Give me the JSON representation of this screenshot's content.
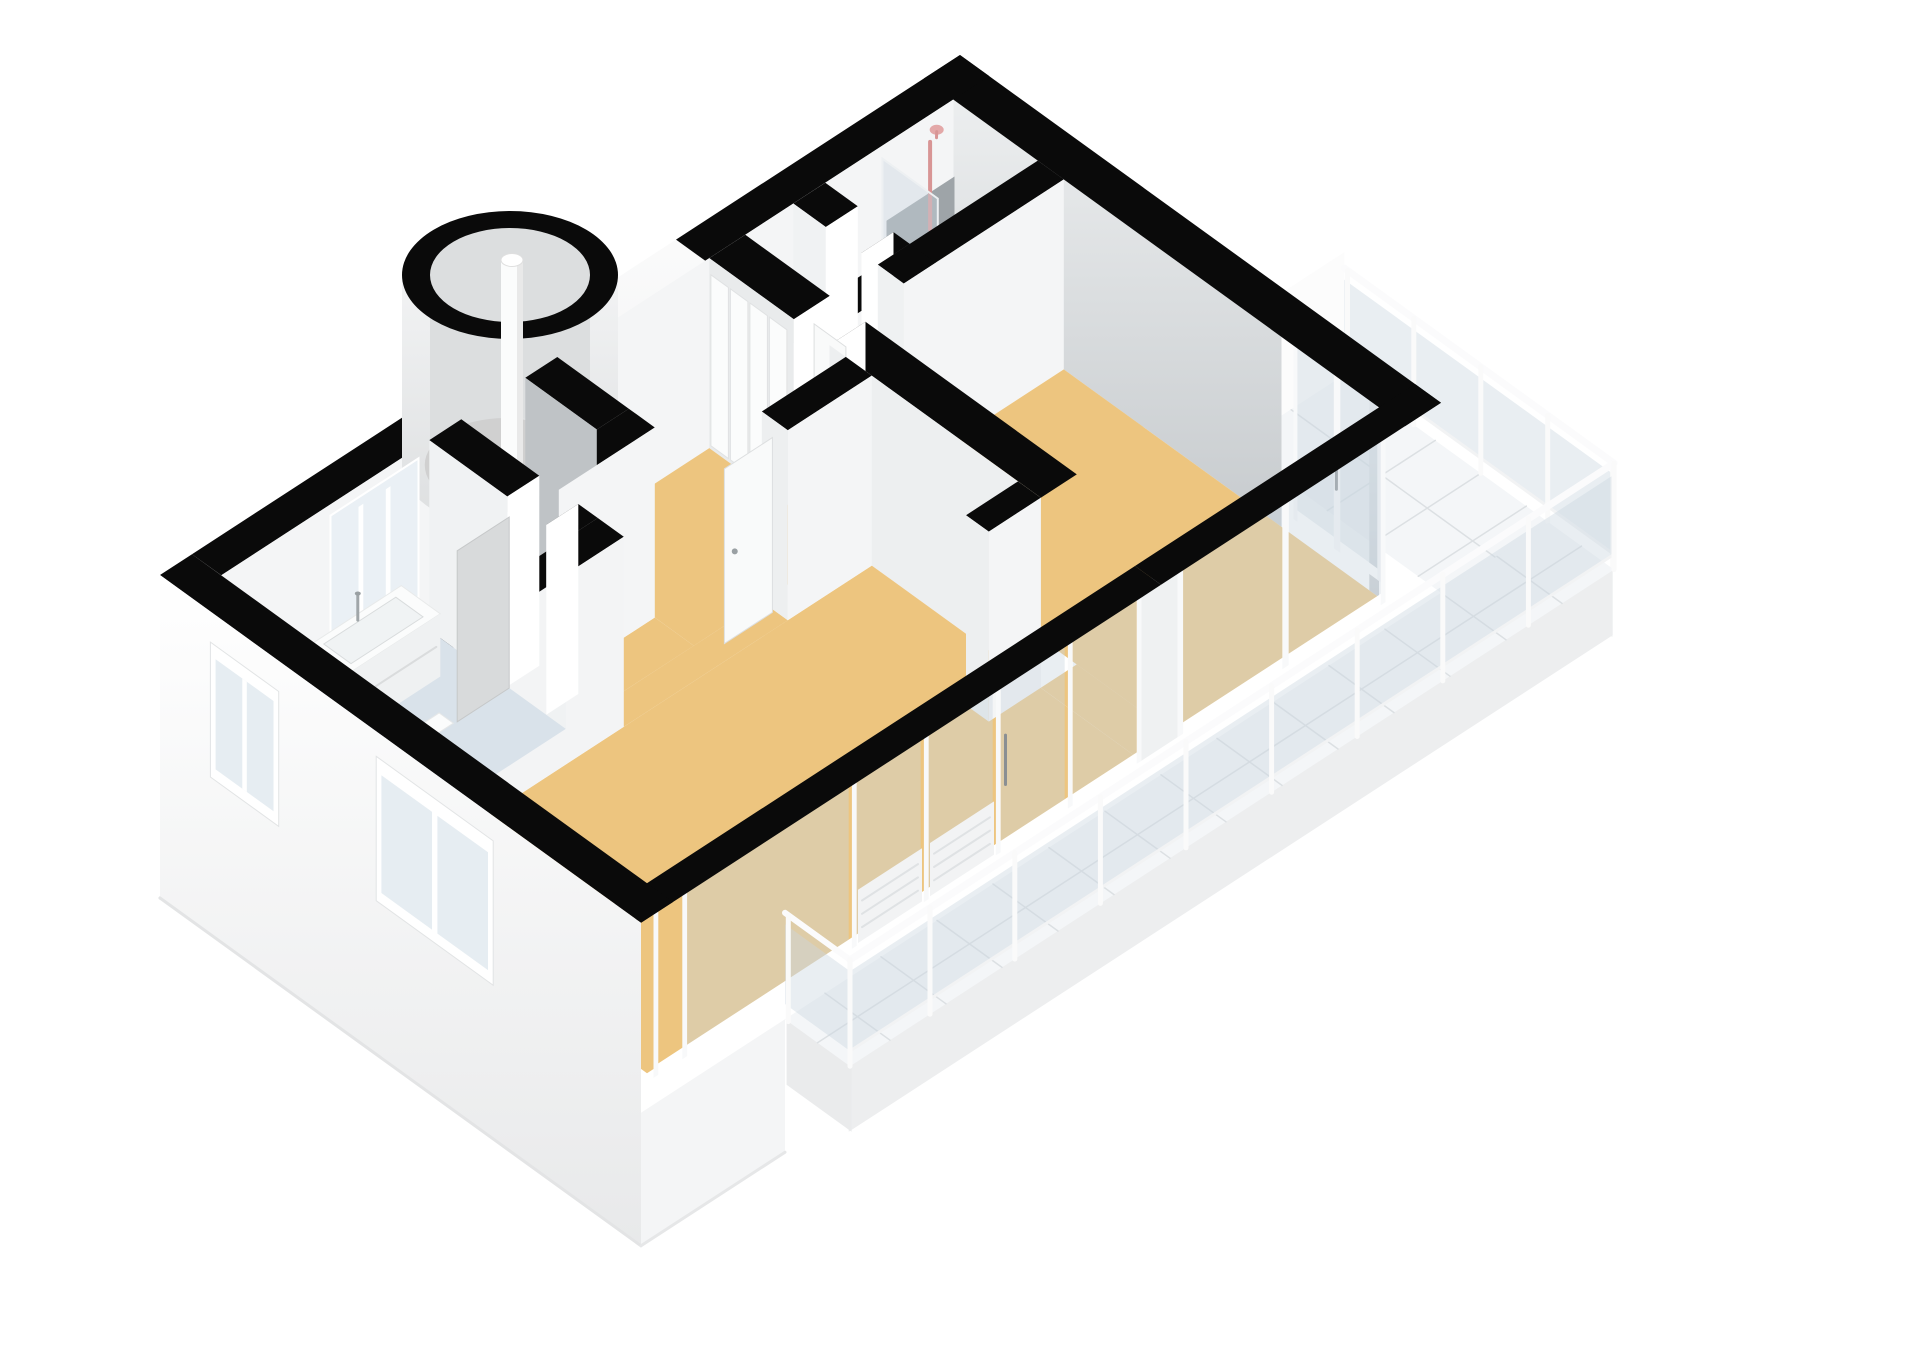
{
  "scene": {
    "label": "3D isometric floor plan of an apartment",
    "background": "#FFFFFF",
    "style": "isometric-3d-floorplan"
  },
  "palette": {
    "wall_top": "#0A0A0A",
    "wall_face_bright": "#F4F5F6",
    "wall_face_medium": "#EDEFF0",
    "wall_face_shaded": "#C7CBCE",
    "wall_face_dark": "#9EA4A8",
    "exterior_white": "#FFFFFF",
    "exterior_shade": "#E8E9EA",
    "floor_wood": "#EDC57F",
    "floor_bath": "#D9E2EA",
    "floor_tile": "#F4F6F8",
    "tile_line": "#DCE0E3",
    "floor_dark": "#3B3C3E",
    "floor_turret": "#D0D0D0",
    "glass": "rgba(203,214,224,0.42)",
    "glass_pane": "#E8EEF3",
    "frame_white": "#FFFFFF",
    "fixture_white": "#FBFCFC",
    "fixture_accent": "#D89595",
    "shadow": "#CBD0D4"
  },
  "rooms": [
    {
      "id": "living-room",
      "floor": "floor_wood"
    },
    {
      "id": "bedroom",
      "floor": "floor_wood"
    },
    {
      "id": "hallway",
      "floor": "floor_wood"
    },
    {
      "id": "corridor",
      "floor": "floor_wood"
    },
    {
      "id": "bathroom",
      "floor": "floor_bath"
    },
    {
      "id": "shower-room",
      "floor": "floor_bath"
    },
    {
      "id": "storage-closet",
      "floor": "floor_dark"
    },
    {
      "id": "turret-stairwell",
      "floor": "floor_turret"
    },
    {
      "id": "balcony",
      "floor": "floor_tile"
    }
  ],
  "fixtures": [
    "spiral-stair-column",
    "shower-set",
    "shower-glass-screen",
    "vanity-sink",
    "toilet",
    "counter-niche",
    "wardrobe-sliding-doors",
    "bedroom-door",
    "hall-door",
    "bathroom-door",
    "sliding-glass-door",
    "glass-railing",
    "nw-window",
    "bathroom-window",
    "living-window"
  ]
}
